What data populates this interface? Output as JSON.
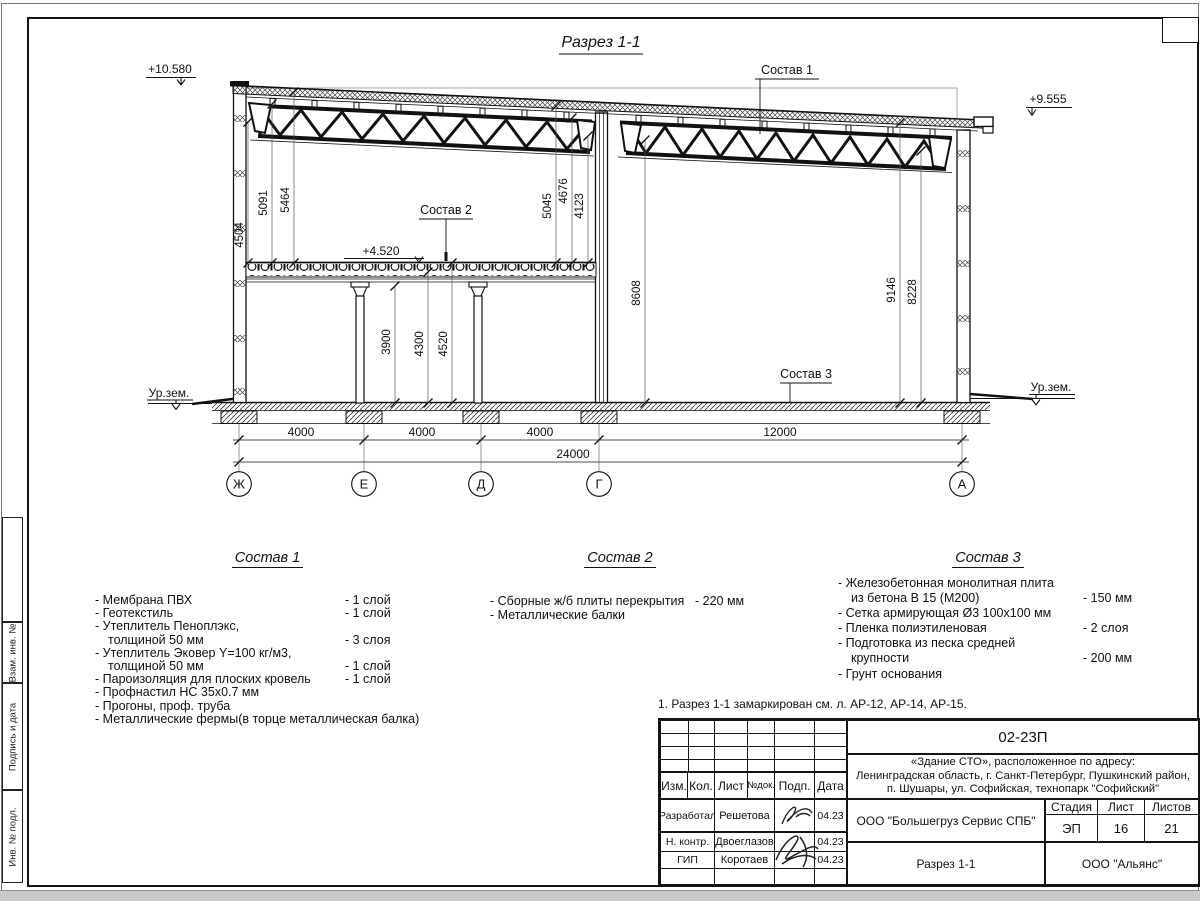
{
  "drawing": {
    "title": "Разрез 1-1",
    "levels": {
      "topLeft": "+10.580",
      "topRight": "+9.555",
      "floor": "+4.520",
      "groundLeft": "Ур.зем.",
      "groundRight": "Ур.зем."
    },
    "callouts": {
      "c1": "Состав 1",
      "c2": "Состав 2",
      "c3": "Состав 3"
    },
    "dims": {
      "left1": "4504",
      "left2": "5091",
      "left3": "5464",
      "mid1": "5045",
      "mid2": "4676",
      "mid3": "4123",
      "hall": "8608",
      "right1": "9146",
      "right2": "8228",
      "int1": "3900",
      "int2": "4300",
      "int3": "4520",
      "b1": "4000",
      "b2": "4000",
      "b3": "4000",
      "b4": "12000",
      "total": "24000"
    },
    "axes": {
      "a1": "Ж",
      "a2": "Е",
      "a3": "Д",
      "a4": "Г",
      "a5": "А"
    }
  },
  "sostav1": {
    "title": "Состав 1",
    "rows": [
      {
        "l": "- Мембрана ПВХ",
        "r": "- 1 слой"
      },
      {
        "l": "- Геотекстиль",
        "r": "- 1 слой"
      },
      {
        "l": "- Утеплитель Пеноплэкс,",
        "r": ""
      },
      {
        "l": "толщиной 50 мм",
        "r": "- 3 слоя"
      },
      {
        "l": "- Утеплитель Эковер Y=100 кг/м3,",
        "r": ""
      },
      {
        "l": "толщиной 50 мм",
        "r": "- 1 слой"
      },
      {
        "l": "- Пароизоляция для плоских кровель",
        "r": "- 1 слой"
      },
      {
        "l": "- Профнастил НС 35х0.7 мм",
        "r": ""
      },
      {
        "l": "- Прогоны, проф. труба",
        "r": ""
      },
      {
        "l": "- Металлические фермы(в торце металлическая балка)",
        "r": ""
      }
    ]
  },
  "sostav2": {
    "title": "Состав 2",
    "rows": [
      {
        "l": "- Сборные ж/б плиты перекрытия",
        "r": "- 220 мм"
      },
      {
        "l": "- Металлические балки",
        "r": ""
      }
    ]
  },
  "sostav3": {
    "title": "Состав 3",
    "rows": [
      {
        "l": "- Железобетонная  монолитная плита",
        "r": ""
      },
      {
        "l": "из бетона В 15 (М200)",
        "r": "- 150 мм"
      },
      {
        "l": "- Сетка армирующая Ø3 100х100 мм",
        "r": ""
      },
      {
        "l": "- Пленка полиэтиленовая",
        "r": "-  2 слоя"
      },
      {
        "l": "- Подготовка из песка средней",
        "r": ""
      },
      {
        "l": "крупности",
        "r": "- 200 мм"
      },
      {
        "l": "- Грунт основания",
        "r": ""
      }
    ]
  },
  "note": "1. Разрез 1-1 замаркирован см. л. АР-12, АР-14, АР-15.",
  "titleblock": {
    "code": "02-23П",
    "object1": "«Здание СТО», расположенное по адресу:",
    "object2": "Ленинградская область, г. Санкт-Петербург, Пушкинский район,",
    "object3": "п. Шушары, ул. Софийская, технопарк \"Софийский\"",
    "col_izm": "Изм.",
    "col_kol": "Кол.",
    "col_list": "Лист",
    "col_ndok": "№док.",
    "col_podp": "Подп.",
    "col_data": "Дата",
    "r1_role": "Разработал",
    "r1_name": "Решетова",
    "r1_date": "04.23",
    "r2_role": "Н. контр.",
    "r2_name": "Двоеглазов",
    "r2_date": "04.23",
    "r3_role": "ГИП",
    "r3_name": "Коротаев",
    "r3_date": "04.23",
    "org1": "ООО \"Большегруз Сервис СПБ\"",
    "stage_label": "Стадия",
    "list_label": "Лист",
    "listov_label": "Листов",
    "stage": "ЭП",
    "list": "16",
    "listov": "21",
    "sheet_title": "Разрез 1-1",
    "org2": "ООО \"Альянс\""
  },
  "side": {
    "s1": "Взам. инв. №",
    "s2": "Подпись и дата",
    "s3": "Инв. № подл."
  }
}
